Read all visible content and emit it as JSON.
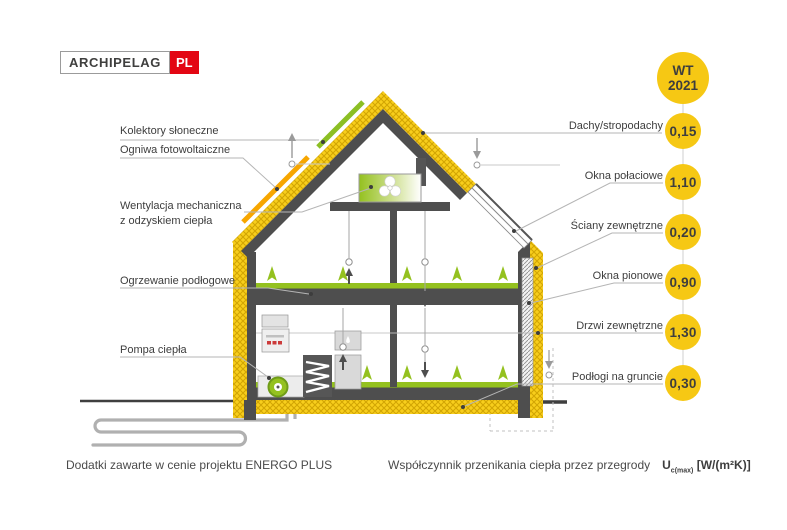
{
  "logo": {
    "brand": "ARCHIPELAG",
    "country": "PL"
  },
  "badge": {
    "top": "WT",
    "bottom": "2021"
  },
  "left_labels": [
    {
      "label": "Kolektory słoneczne"
    },
    {
      "label": "Ogniwa fotowoltaiczne"
    },
    {
      "label": "Wentylacja mechaniczna",
      "label2": "z odzyskiem ciepła"
    },
    {
      "label": "Ogrzewanie podłogowe"
    },
    {
      "label": "Pompa ciepła"
    }
  ],
  "right_labels": [
    {
      "label": "Dachy/stropodachy",
      "value": "0,15"
    },
    {
      "label": "Okna połaciowe",
      "value": "1,10"
    },
    {
      "label": "Ściany zewnętrzne",
      "value": "0,20"
    },
    {
      "label": "Okna pionowe",
      "value": "0,90"
    },
    {
      "label": "Drzwi zewnętrzne",
      "value": "1,30"
    },
    {
      "label": "Podłogi na gruncie",
      "value": "0,30"
    }
  ],
  "footer": {
    "left": "Dodatki zawarte w cenie projektu ENERGO PLUS",
    "right_text": "Współczynnik przenikania ciepła przez przegrody",
    "symbol": "U",
    "symbol_sub": "c(max)",
    "unit": "[W/(m²K)]"
  },
  "colors": {
    "accent_yellow": "#F6C814",
    "wall_gray": "#4E4E4E",
    "eco_green": "#94C11F",
    "strip_green": "#8CBF24",
    "strip_orange": "#F7A600",
    "logo_red": "#E30613"
  }
}
